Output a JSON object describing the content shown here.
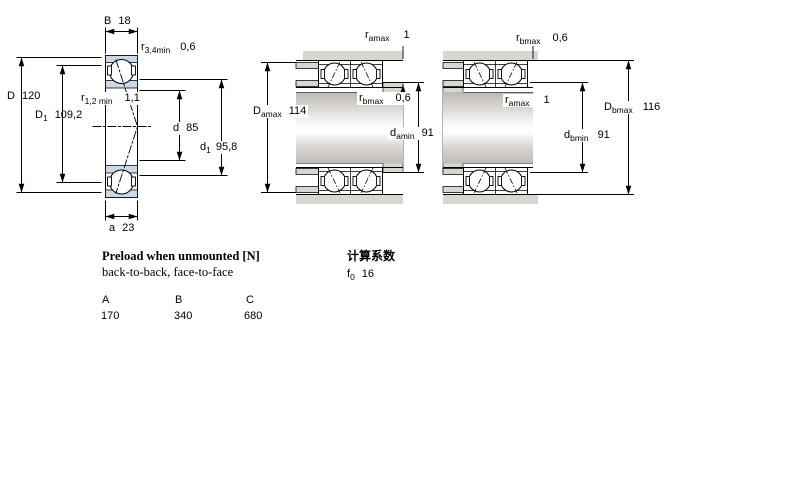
{
  "left_view": {
    "dim_B": {
      "base": "B",
      "sub": "",
      "value": "18"
    },
    "dim_r34": {
      "base": "r",
      "sub": "3,4min",
      "value": "0,6"
    },
    "dim_D": {
      "base": "D",
      "sub": "",
      "value": "120"
    },
    "dim_D1": {
      "base": "D",
      "sub": "1",
      "value": "109,2"
    },
    "dim_r12": {
      "base": "r",
      "sub": "1,2 min",
      "value": "1,1"
    },
    "dim_d": {
      "base": "d",
      "sub": "",
      "value": "85"
    },
    "dim_d1": {
      "base": "d",
      "sub": "1",
      "value": "95,8"
    },
    "dim_a": {
      "base": "a",
      "sub": "",
      "value": "23"
    }
  },
  "middle_view": {
    "dim_ramax": {
      "base": "r",
      "sub": "amax",
      "value": "1"
    },
    "dim_rbmax": {
      "base": "r",
      "sub": "bmax",
      "value": "0,6"
    },
    "dim_Damax": {
      "base": "D",
      "sub": "amax",
      "value": "114"
    },
    "dim_damin": {
      "base": "d",
      "sub": "amin",
      "value": "91"
    }
  },
  "right_view": {
    "dim_rbmax": {
      "base": "r",
      "sub": "bmax",
      "value": "0,6"
    },
    "dim_ramax": {
      "base": "r",
      "sub": "amax",
      "value": "1"
    },
    "dim_Dbmax": {
      "base": "D",
      "sub": "bmax",
      "value": "116"
    },
    "dim_dbmin": {
      "base": "d",
      "sub": "bmin",
      "value": "91"
    }
  },
  "info": {
    "preload_title": "Preload when unmounted [N]",
    "preload_subtitle": "back-to-back, face-to-face",
    "calc_title": "计算系数",
    "f0": {
      "base": "f",
      "sub": "0",
      "value": "16"
    },
    "table": {
      "headers": [
        "A",
        "B",
        "C"
      ],
      "values": [
        "170",
        "340",
        "680"
      ]
    }
  },
  "colors": {
    "bearing_ring_fill": "#c8d9e9",
    "metal_fill": "#d9d6d2",
    "line": "#000000"
  }
}
